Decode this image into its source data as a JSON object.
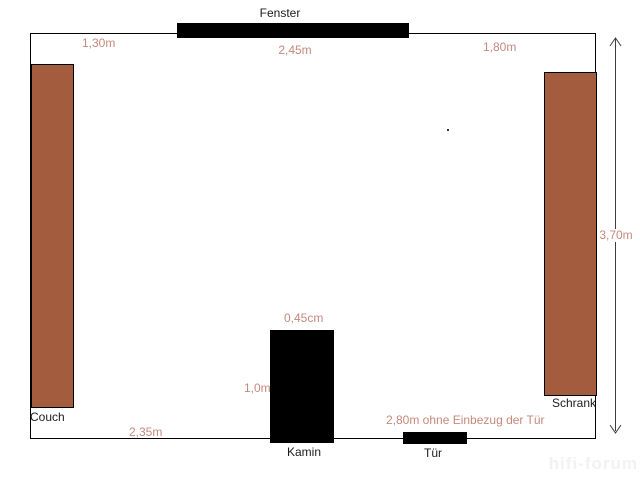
{
  "labels": {
    "fenster": "Fenster",
    "couch": "Couch",
    "schrank": "Schrank",
    "kamin": "Kamin",
    "tuer": "Tür"
  },
  "measurements": {
    "wall_left_of_window": "1,30m",
    "window_width": "2,45m",
    "wall_right_of_window": "1,80m",
    "room_depth": "3,70m",
    "wall_left_of_kamin": "2,35m",
    "kamin_width": "0,45cm",
    "kamin_depth": "1,0m",
    "tuer_note": "2,80m ohne Einbezug der Tür"
  },
  "watermark": "hifi-forum",
  "colors": {
    "furniture_fill": "#a35c3e",
    "fixture_fill": "#000000",
    "measurement_text": "#c4897b",
    "label_text": "#1c1c1c",
    "wall_line": "#000000"
  }
}
